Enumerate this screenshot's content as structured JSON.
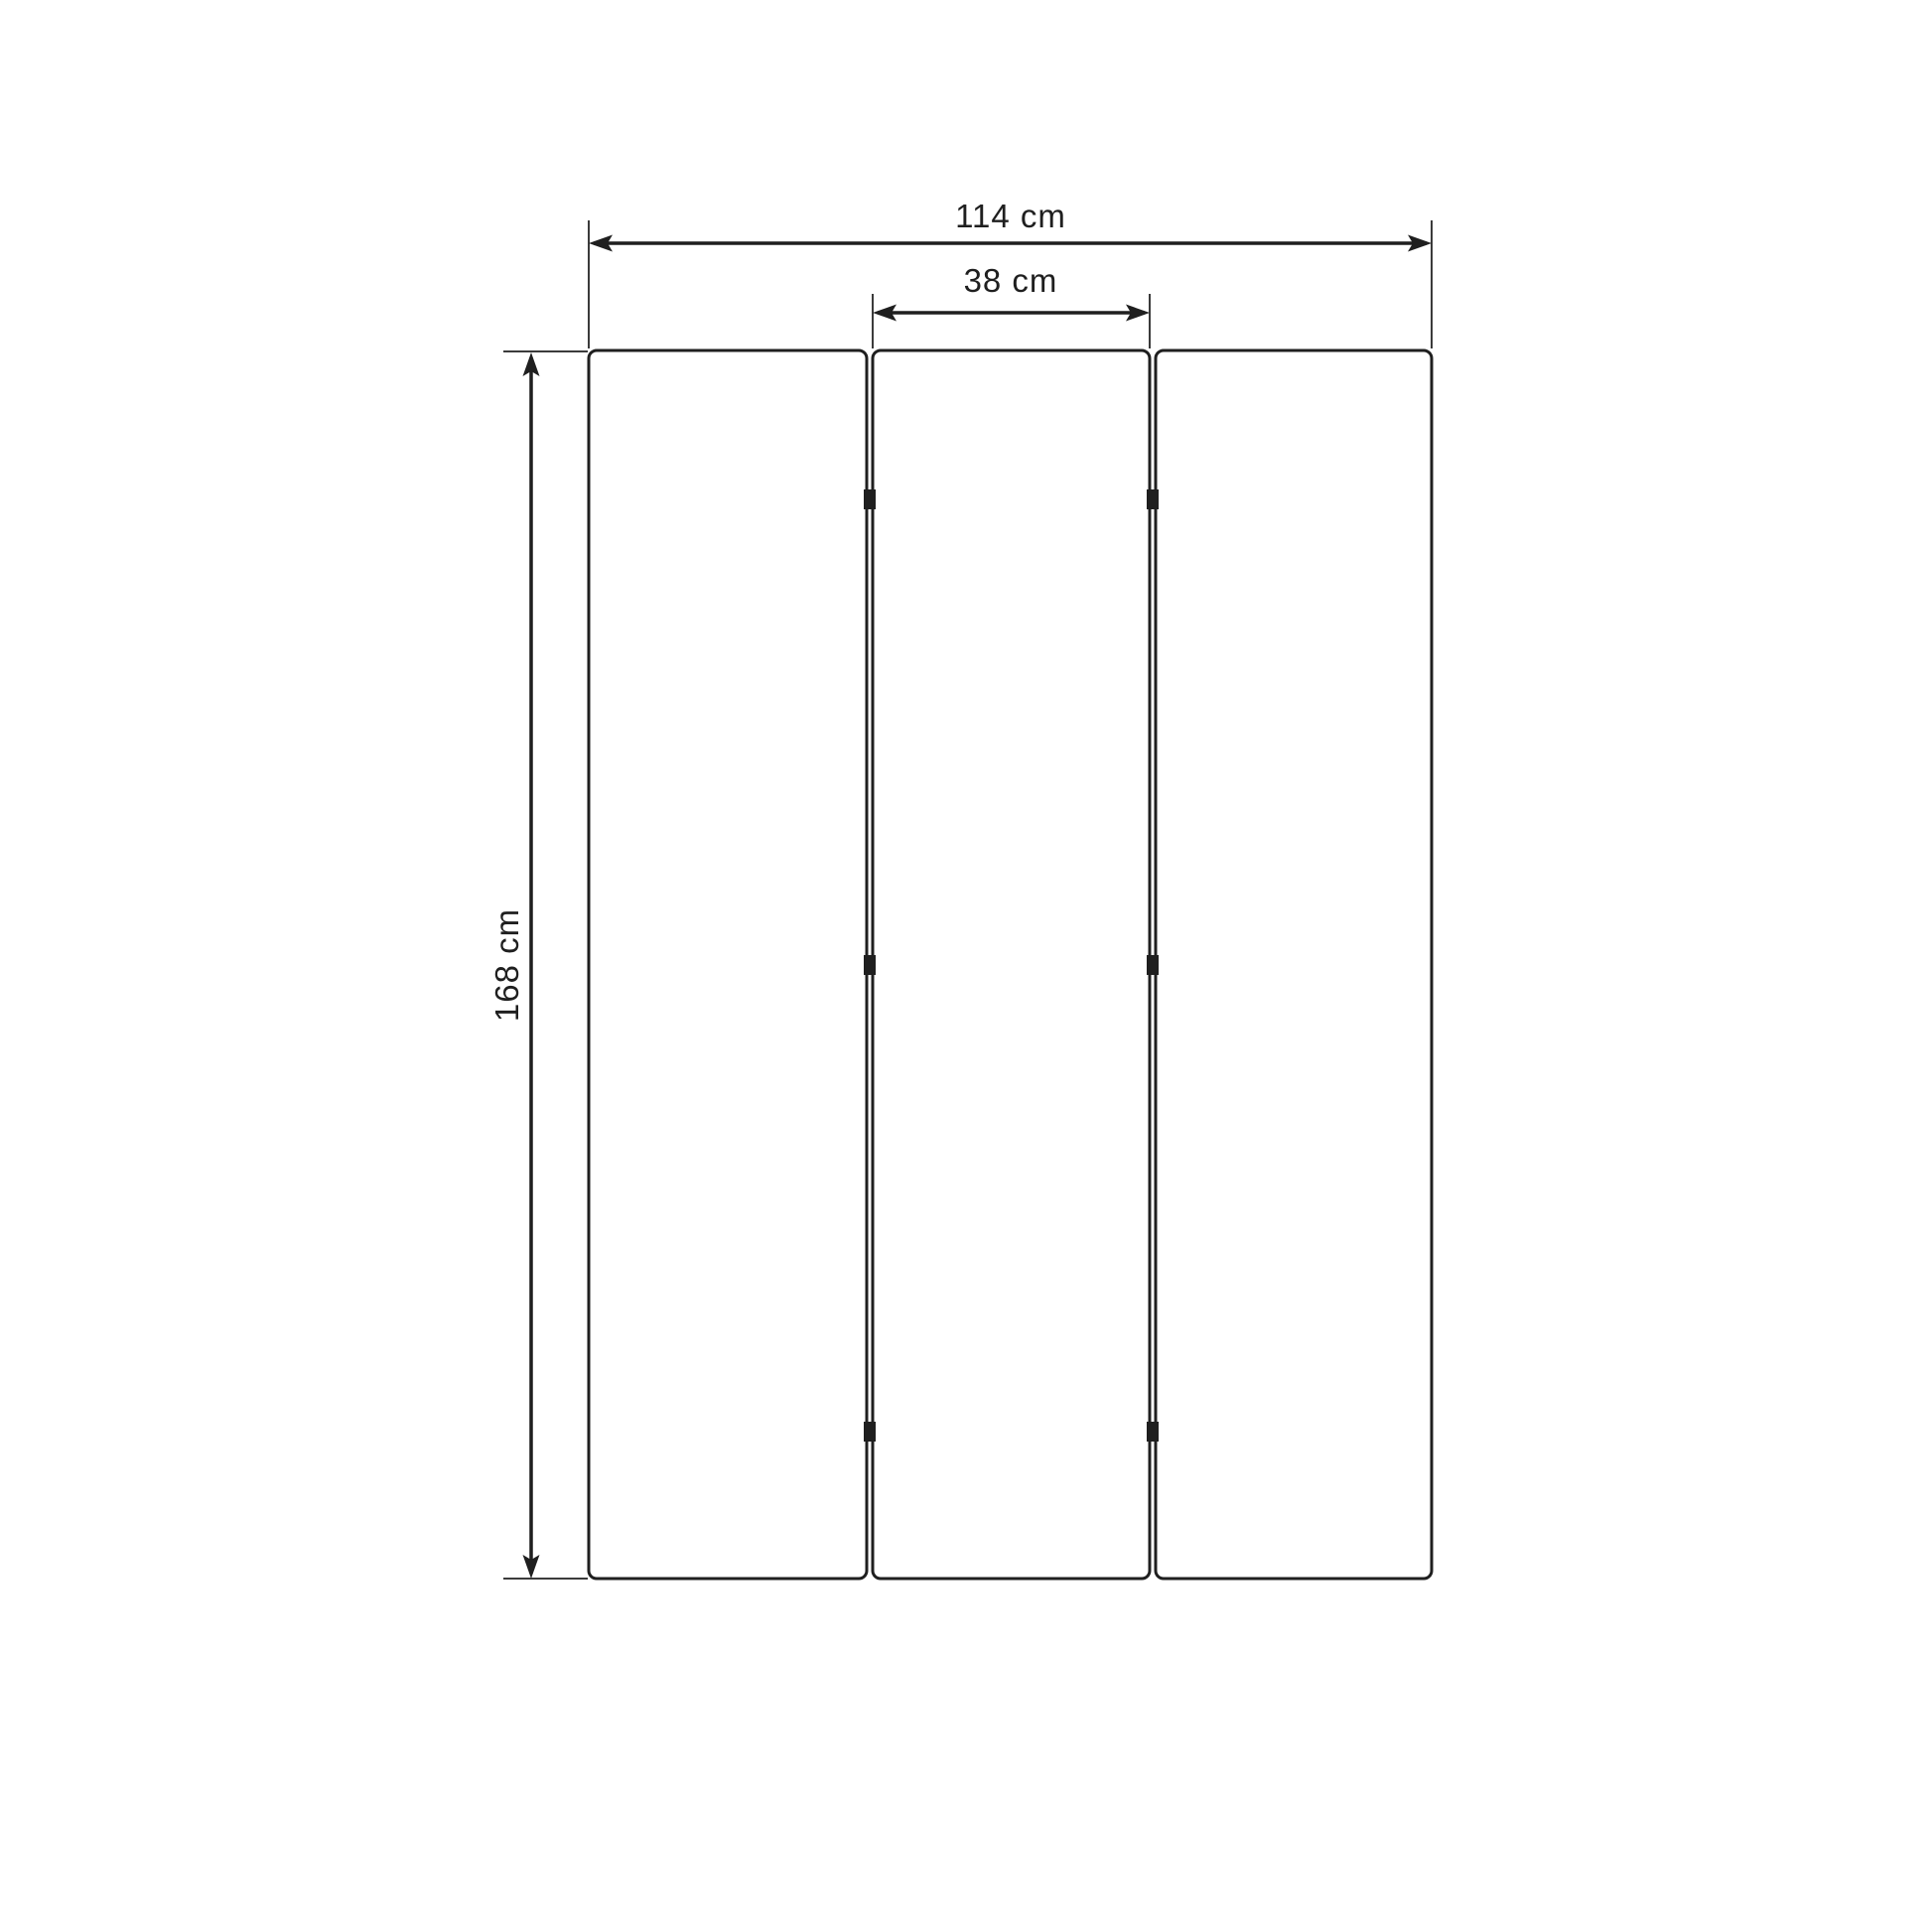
{
  "page": {
    "background_color": "#ffffff"
  },
  "drawing": {
    "line_color": "#1f1f1f",
    "panel_fill": "#ffffff",
    "panels": {
      "count": 3,
      "hinge_marks_per_gap": 3
    },
    "dimensions": {
      "total_width": {
        "label": "114 cm",
        "value": 114,
        "unit": "cm",
        "orientation": "horizontal"
      },
      "center_panel_width": {
        "label": "38 cm",
        "value": 38,
        "unit": "cm",
        "orientation": "horizontal"
      },
      "height": {
        "label": "168 cm",
        "value": 168,
        "unit": "cm",
        "orientation": "vertical"
      }
    }
  }
}
